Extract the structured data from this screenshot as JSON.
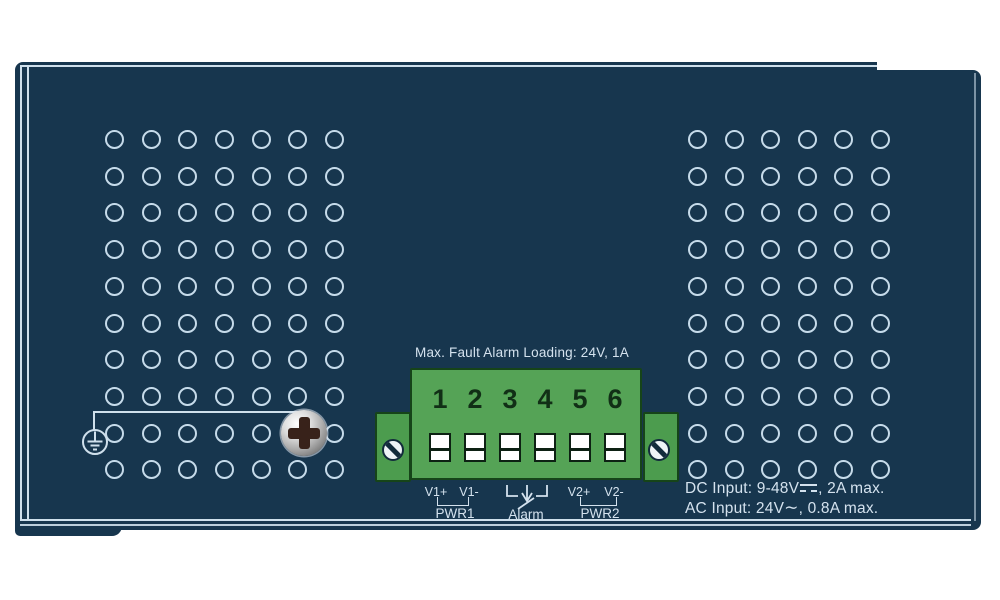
{
  "device": {
    "kind": "industrial switch top panel illustration",
    "colors": {
      "panel": "#17364e",
      "edge_line": "#cfe0ec",
      "vent_hole": "#c6dbea",
      "text": "#d4e2ee",
      "terminal_green": "#55a356",
      "terminal_green_dark": "#164419",
      "screw_cross": "#38221a"
    },
    "vent_grids": {
      "left": {
        "cols": 7,
        "rows": 10,
        "x0": 115,
        "y0": 140,
        "dx": 36.65,
        "dy": 36.7,
        "skip": [
          [
            5,
            8
          ]
        ]
      },
      "right": {
        "cols": 6,
        "rows": 10,
        "x0": 698,
        "y0": 140,
        "dx": 36.5,
        "dy": 36.7,
        "skip": []
      }
    },
    "icons": {
      "ground": "protective-earth-ground-icon",
      "chassis_screw": "phillips-screw-icon",
      "terminal_screw": "slotted-screw-icon",
      "dc": "direct-current-symbol-icon",
      "ac": "alternating-current-symbol-icon",
      "alarm_arrow": "alarm-relay-arrow-icon"
    },
    "terminal_block": {
      "note": "Max. Fault Alarm Loading: 24V, 1A",
      "numbers": [
        "1",
        "2",
        "3",
        "4",
        "5",
        "6"
      ],
      "labels": {
        "v1p": "V1+",
        "v1m": "V1-",
        "pwr1": "PWR1",
        "alarm": "Alarm",
        "v2p": "V2+",
        "v2m": "V2-",
        "pwr2": "PWR2"
      }
    },
    "ratings": {
      "dc_prefix": "DC Input: 9-48V",
      "dc_suffix": ", 2A max.",
      "ac_prefix": "AC Input: 24V",
      "ac_symbol": "∼",
      "ac_suffix": ", 0.8A max."
    }
  }
}
